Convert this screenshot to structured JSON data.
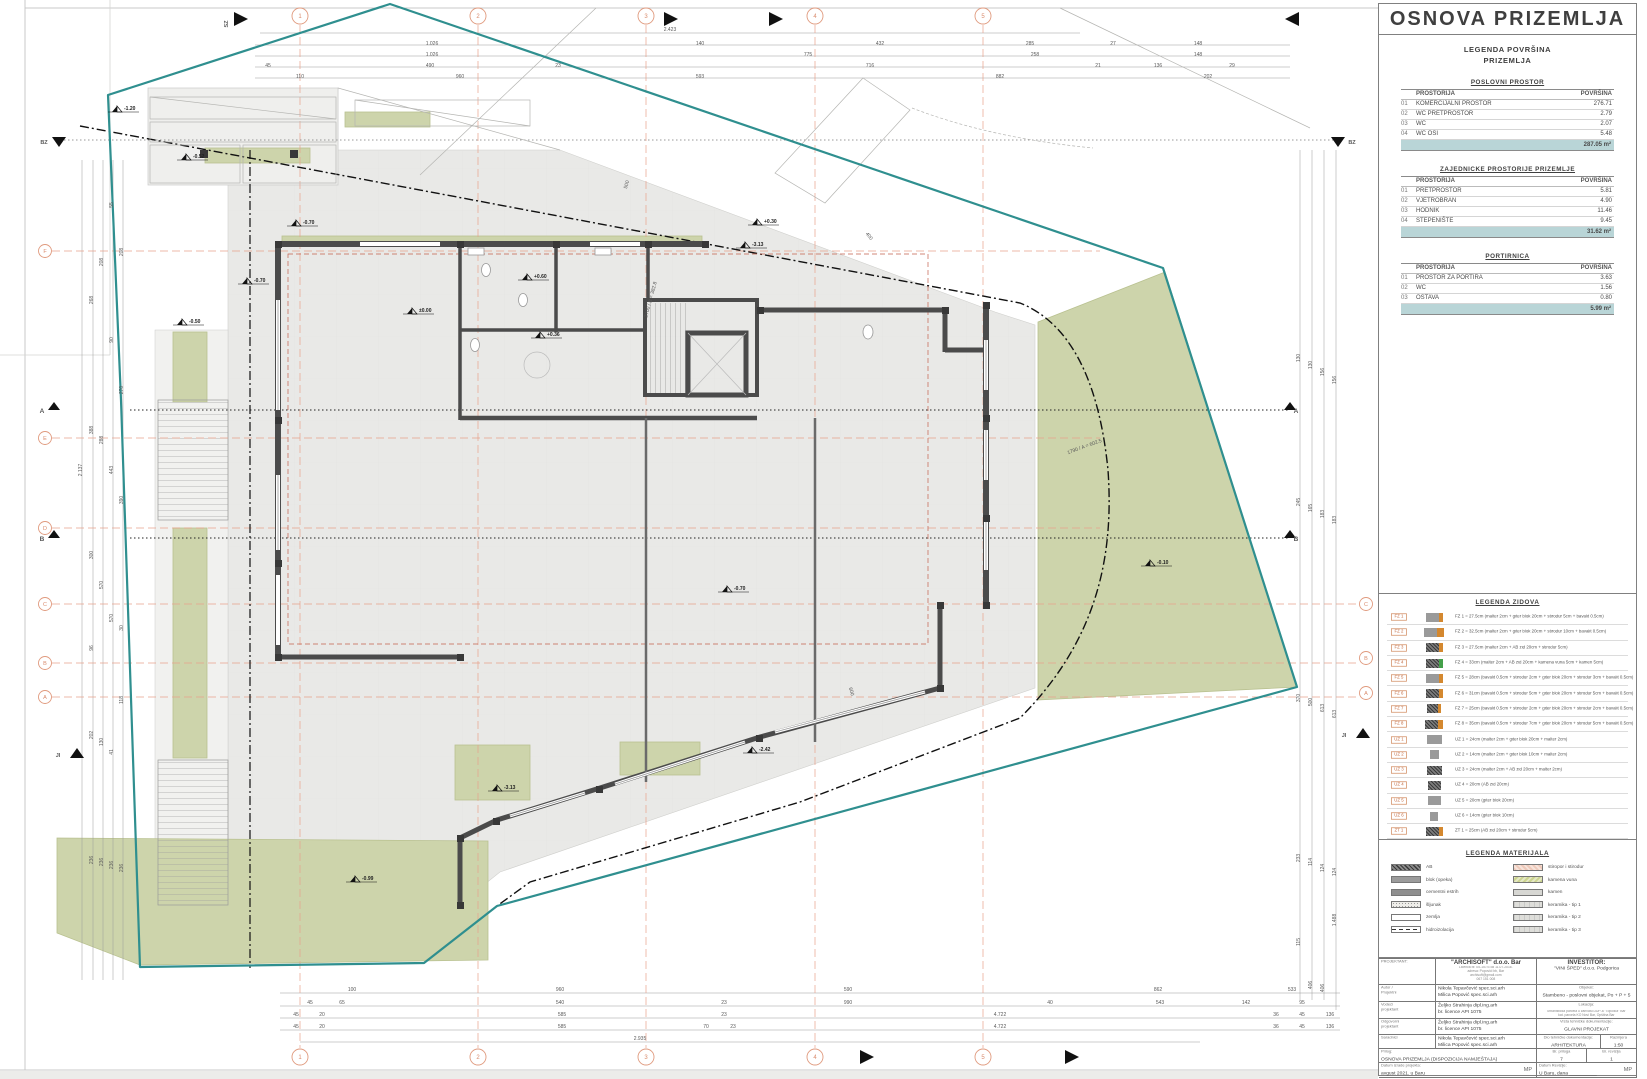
{
  "sheet": {
    "title": "OSNOVA PRIZEMLJA"
  },
  "colors": {
    "boundary": "#2f8f8f",
    "green": "#cdd4ab",
    "axis": "#e8a18c",
    "wall": "#4b4b4b",
    "total_row": "#b9d5d7",
    "tag": "#c2673c"
  },
  "legend": {
    "heading_line1": "LEGENDA POVRŠINA",
    "heading_line2": "PRIZEMLJA",
    "tables": [
      {
        "name": "POSLOVNI PROSTOR",
        "col_room": "PROSTORIJA",
        "col_area": "POVRŠINA",
        "rows": [
          [
            "01",
            "KOMERCIJALNI PROSTOR",
            "276.71"
          ],
          [
            "02",
            "WC PRETPROSTOR",
            "2.79"
          ],
          [
            "03",
            "WC",
            "2.07"
          ],
          [
            "04",
            "WC OSI",
            "5.48"
          ]
        ],
        "total": "287.05 m²"
      },
      {
        "name": "ZAJEDNICKE PROSTORIJE PRIZEMLJE",
        "col_room": "PROSTORIJA",
        "col_area": "POVRŠINA",
        "rows": [
          [
            "01",
            "PRETPROSTOR",
            "5.81"
          ],
          [
            "02",
            "VJETROBRAN",
            "4.90"
          ],
          [
            "03",
            "HODNIK",
            "11.46"
          ],
          [
            "04",
            "STEPENIŠTE",
            "9.45"
          ]
        ],
        "total": "31.62 m²"
      },
      {
        "name": "PORTIRNICA",
        "col_room": "PROSTORIJA",
        "col_area": "POVRŠINA",
        "rows": [
          [
            "01",
            "PROSTOR ZA PORTIRA",
            "3.63"
          ],
          [
            "02",
            "WC",
            "1.56"
          ],
          [
            "03",
            "OSTAVA",
            "0.80"
          ]
        ],
        "total": "5.99 m²"
      }
    ]
  },
  "walls_legend": {
    "title": "LEGENDA ZIDOVA",
    "rows": [
      {
        "tag": "FZ 1",
        "desc": "FZ 1 = 27.5cm (malter 2cm + giter blok 20cm + stirodur 5cm + bavalit 0.5cm)",
        "base": "g",
        "bw": 13,
        "ext": "o",
        "ew": 4
      },
      {
        "tag": "FZ 2",
        "desc": "FZ 2 = 32.5cm (malter 2cm + giter blok 20cm + stirodur 10cm + bavalit 0.5cm)",
        "base": "g",
        "bw": 13,
        "ext": "o",
        "ew": 7
      },
      {
        "tag": "FZ 3",
        "desc": "FZ 3 = 27.5cm (malter 2cm + AB zid 20cm + stirodur 5cm)",
        "base": "h",
        "bw": 13,
        "ext": "o",
        "ew": 4
      },
      {
        "tag": "FZ 4",
        "desc": "FZ 4 = 33cm (malter 2cm + AB zid 20cm + kamena vuna 5cm + kamen 5cm)",
        "base": "h",
        "bw": 13,
        "ext": "gr",
        "ew": 4
      },
      {
        "tag": "FZ 5",
        "desc": "FZ 5 = 28cm (bavalit 0.5cm + stirodur 2cm + giter blok 20cm + stirodur 3cm + bavalit 0.5cm)",
        "base": "g",
        "bw": 13,
        "ext": "o",
        "ew": 4
      },
      {
        "tag": "FZ 6",
        "desc": "FZ 6 = 31cm (bavalit 0.5cm + stirodur 5cm + giter blok 20cm + stirodur 5cm + bavalit 0.5cm)",
        "base": "h",
        "bw": 13,
        "ext": "o",
        "ew": 4
      },
      {
        "tag": "FZ 7",
        "desc": "FZ 7 = 25cm (bavalit 0.5cm + stirodur 2cm + giter blok 20cm + stirodur 2cm + bavalit 0.5cm)",
        "base": "h",
        "bw": 11,
        "ext": "o",
        "ew": 3
      },
      {
        "tag": "FZ 8",
        "desc": "FZ 8 = 35cm (bavalit 0.5cm + stirodur 7cm + giter blok 20cm + stirodur 5cm + bavalit 0.5cm)",
        "base": "h",
        "bw": 13,
        "ext": "o",
        "ew": 5
      },
      {
        "tag": "UZ 1",
        "desc": "UZ 1 = 24cm (malter 2cm + giter blok 20cm + malter 2cm)",
        "base": "g",
        "bw": 15,
        "ext": "",
        "ew": 0
      },
      {
        "tag": "UZ 2",
        "desc": "UZ 2 = 14cm (malter 2cm + giter blok 10cm + malter 2cm)",
        "base": "g",
        "bw": 9,
        "ext": "",
        "ew": 0
      },
      {
        "tag": "UZ 3",
        "desc": "UZ 3 = 24cm (malter 2cm + AB zid 20cm + malter 2cm)",
        "base": "h",
        "bw": 15,
        "ext": "",
        "ew": 0
      },
      {
        "tag": "UZ 4",
        "desc": "UZ 4 = 20cm (AB zid 20cm)",
        "base": "h",
        "bw": 13,
        "ext": "",
        "ew": 0
      },
      {
        "tag": "UZ 5",
        "desc": "UZ 5 = 20cm (giter blok 20cm)",
        "base": "g",
        "bw": 13,
        "ext": "",
        "ew": 0
      },
      {
        "tag": "UZ 6",
        "desc": "UZ 6 = 14cm (giter blok 10cm)",
        "base": "g",
        "bw": 8,
        "ext": "",
        "ew": 0
      },
      {
        "tag": "ZT 1",
        "desc": "ZT 1 = 25cm (AB zid 20cm + stirodur 5cm)",
        "base": "h",
        "bw": 13,
        "ext": "o",
        "ew": 4
      }
    ]
  },
  "materials_legend": {
    "title": "LEGENDA MATERIJALA",
    "left": [
      {
        "n": "AB",
        "cls": "sw-ab"
      },
      {
        "n": "blok (opeka)",
        "cls": "sw-blok"
      },
      {
        "n": "cementni estrih",
        "cls": "sw-estrih"
      },
      {
        "n": "šljunak",
        "cls": "sw-sljunak"
      },
      {
        "n": "zemlja",
        "cls": "sw-zemlja"
      },
      {
        "n": "hidroizolacija",
        "cls": "sw-hidro"
      }
    ],
    "right": [
      {
        "n": "stiropor i stirodur",
        "cls": "sw-stiropor"
      },
      {
        "n": "kamena vuna",
        "cls": "sw-vuna"
      },
      {
        "n": "kamen",
        "cls": "sw-kamen"
      },
      {
        "n": "keramika - tip 1",
        "cls": "sw-ker"
      },
      {
        "n": "keramika - tip 2",
        "cls": "sw-ker"
      },
      {
        "n": "keramika - tip 3",
        "cls": "sw-ker"
      }
    ]
  },
  "title_block": {
    "projektant_label": "PROJEKTANT:",
    "projektant_name": "\"ARCHISOFT\" d.o.o. Bar",
    "projektant_details": "Licenca br. 05-157/3 od 11.07.2016.\nadresa: Popovići bb, Bar\narchisoft@gmail.com\n067 151 008",
    "rows": [
      {
        "label": "Autor /\nProjektni",
        "value": "Nikola Tepavčević spec.sci.arh\nMilica Popović spec.sci.arh"
      },
      {
        "label": "Vodeći\nprojektant",
        "value": "Željko Strahinja dipl.ing.arh\nbr. licence API 1075"
      },
      {
        "label": "Odgovorni\nprojektant",
        "value": "Željko Strahinja dipl.ing.arh\nbr. licence API 1075"
      },
      {
        "label": "Saradnici",
        "value": "Nikola Tepavčević spec.sci.arh\nMilica Popović spec.sci.arh"
      }
    ],
    "prilog_label": "Prilog:",
    "prilog": "OSNOVA PRIZEMLJA (DISPOZICIJA NAMJEŠTAJA)",
    "datum_label": "Datum izrade projekta:",
    "datum": "avgust 2021. u Baru",
    "mp": "MP",
    "investitor_label": "INVESTITOR:",
    "investitor": "\"VINI ŠPED\" d.o.o. Podgorica",
    "objekat_label": "Objekat:",
    "objekat": "Stambeno - poslovni objekat, Po + P + 5",
    "lokacija_label": "Lokacija:",
    "lokacija": "urbanistička parcela u zahvatu DUP-a \"Topolica\" Bar\nkat. parcela KO Novi Bar, Opština Bar",
    "vrsta_label": "Vrsta tehničke dokumentacije:",
    "vrsta": "GLAVNI PROJEKAT",
    "dio_label": "Dio tehničke dokumentacije:",
    "dio": "ARHITEKTURA",
    "razmjera_label": "Razmjera",
    "razmjera": "1:50",
    "br_priloga_label": "Br. priloga",
    "br_priloga": "7",
    "br_revizije_label": "Br. revizija",
    "br_revizije": "1",
    "datum_rev_label": "Datum Revizije:",
    "datum_rev": "U Baru, dana __________",
    "mp2": "MP"
  },
  "plan": {
    "texts": [
      [
        670,
        31,
        "2.423"
      ],
      [
        432,
        45,
        "1.026"
      ],
      [
        700,
        45,
        "140"
      ],
      [
        880,
        45,
        "432"
      ],
      [
        1030,
        45,
        "285"
      ],
      [
        1113,
        45,
        "27"
      ],
      [
        1198,
        45,
        "148"
      ],
      [
        432,
        56,
        "1.026"
      ],
      [
        808,
        56,
        "775"
      ],
      [
        1035,
        56,
        "258"
      ],
      [
        1198,
        56,
        "148"
      ],
      [
        268,
        67,
        "45"
      ],
      [
        430,
        67,
        "490"
      ],
      [
        558,
        67,
        "23"
      ],
      [
        870,
        67,
        "716"
      ],
      [
        1098,
        67,
        "21"
      ],
      [
        1158,
        67,
        "136"
      ],
      [
        1232,
        67,
        "29"
      ],
      [
        300,
        78,
        "110"
      ],
      [
        460,
        78,
        "960"
      ],
      [
        700,
        78,
        "593"
      ],
      [
        1000,
        78,
        "882"
      ],
      [
        1208,
        78,
        "202"
      ],
      [
        352,
        991,
        "100"
      ],
      [
        560,
        991,
        "960"
      ],
      [
        848,
        991,
        "590"
      ],
      [
        1158,
        991,
        "862"
      ],
      [
        1292,
        991,
        "533"
      ],
      [
        310,
        1004,
        "45"
      ],
      [
        342,
        1004,
        "65"
      ],
      [
        560,
        1004,
        "540"
      ],
      [
        724,
        1004,
        "23"
      ],
      [
        848,
        1004,
        "990"
      ],
      [
        1050,
        1004,
        "40"
      ],
      [
        1160,
        1004,
        "543"
      ],
      [
        1246,
        1004,
        "142"
      ],
      [
        1302,
        1004,
        "95"
      ],
      [
        296,
        1016,
        "45"
      ],
      [
        322,
        1016,
        "20"
      ],
      [
        562,
        1016,
        "585"
      ],
      [
        724,
        1016,
        "23"
      ],
      [
        1000,
        1016,
        "4.722"
      ],
      [
        1276,
        1016,
        "36"
      ],
      [
        1302,
        1016,
        "45"
      ],
      [
        1330,
        1016,
        "136"
      ],
      [
        296,
        1028,
        "45"
      ],
      [
        322,
        1028,
        "20"
      ],
      [
        562,
        1028,
        "585"
      ],
      [
        706,
        1028,
        "70"
      ],
      [
        733,
        1028,
        "23"
      ],
      [
        1000,
        1028,
        "4.722"
      ],
      [
        1276,
        1028,
        "36"
      ],
      [
        1302,
        1028,
        "45"
      ],
      [
        1330,
        1028,
        "136"
      ],
      [
        640,
        1040,
        "2.935"
      ],
      [
        82,
        470,
        "2.137",
        -90
      ],
      [
        93,
        300,
        "268",
        -90
      ],
      [
        93,
        430,
        "388",
        -90
      ],
      [
        93,
        555,
        "300",
        -90
      ],
      [
        93,
        648,
        "96",
        -90
      ],
      [
        93,
        735,
        "202",
        -90
      ],
      [
        93,
        860,
        "236",
        -90
      ],
      [
        103,
        262,
        "208",
        -90
      ],
      [
        103,
        440,
        "288",
        -90
      ],
      [
        103,
        585,
        "570",
        -90
      ],
      [
        103,
        742,
        "130",
        -90
      ],
      [
        103,
        862,
        "236",
        -90
      ],
      [
        113,
        205,
        "55",
        -90
      ],
      [
        113,
        340,
        "90",
        -90
      ],
      [
        113,
        470,
        "443",
        -90
      ],
      [
        113,
        618,
        "570",
        -90
      ],
      [
        113,
        752,
        "41",
        -90
      ],
      [
        113,
        865,
        "236",
        -90
      ],
      [
        123,
        252,
        "208",
        -90
      ],
      [
        123,
        390,
        "270",
        -90
      ],
      [
        123,
        500,
        "390",
        -90
      ],
      [
        123,
        628,
        "30",
        -90
      ],
      [
        123,
        700,
        "118",
        -90
      ],
      [
        123,
        868,
        "236",
        -90
      ],
      [
        1300,
        358,
        "130",
        -90
      ],
      [
        1300,
        502,
        "245",
        -90
      ],
      [
        1300,
        698,
        "370",
        -90
      ],
      [
        1300,
        858,
        "233",
        -90
      ],
      [
        1300,
        942,
        "115",
        -90
      ],
      [
        1312,
        365,
        "130",
        -90
      ],
      [
        1312,
        508,
        "165",
        -90
      ],
      [
        1312,
        702,
        "500",
        -90
      ],
      [
        1312,
        862,
        "114",
        -90
      ],
      [
        1312,
        985,
        "406",
        -90
      ],
      [
        1324,
        372,
        "156",
        -90
      ],
      [
        1324,
        514,
        "183",
        -90
      ],
      [
        1324,
        708,
        "613",
        -90
      ],
      [
        1324,
        868,
        "124",
        -90
      ],
      [
        1324,
        988,
        "406",
        -90
      ],
      [
        1336,
        380,
        "156",
        -90
      ],
      [
        1336,
        520,
        "183",
        -90
      ],
      [
        1336,
        714,
        "613",
        -90
      ],
      [
        1336,
        872,
        "124",
        -90
      ],
      [
        1336,
        920,
        "1.488",
        -90
      ],
      [
        652,
        300,
        "2700 / B = 382.8",
        -75
      ],
      [
        1085,
        448,
        "1790 / A = 602.5",
        -20
      ],
      [
        628,
        185,
        "500",
        -72
      ],
      [
        868,
        237,
        "400",
        52
      ],
      [
        850,
        692,
        "600",
        72
      ],
      [
        228,
        24,
        "SZ",
        -90,
        5.5,
        1
      ],
      [
        44,
        144,
        "BZ",
        0,
        5.5,
        1
      ],
      [
        1352,
        144,
        "BZ",
        0,
        5.5,
        1
      ],
      [
        58,
        757,
        "JI",
        0,
        5.5,
        1
      ],
      [
        1344,
        737,
        "JI",
        0,
        5.5,
        1
      ],
      [
        42,
        413,
        "A",
        0,
        6.5,
        1
      ],
      [
        42,
        541,
        "B",
        0,
        6.5,
        1
      ],
      [
        1296,
        413,
        "A",
        0,
        6.5,
        1
      ],
      [
        1296,
        541,
        "B",
        0,
        6.5,
        1
      ]
    ],
    "bubbles": [
      [
        300,
        16,
        "1"
      ],
      [
        478,
        16,
        "2"
      ],
      [
        646,
        16,
        "3"
      ],
      [
        815,
        16,
        "4"
      ],
      [
        983,
        16,
        "5"
      ],
      [
        300,
        1057,
        "1"
      ],
      [
        478,
        1057,
        "2"
      ],
      [
        646,
        1057,
        "3"
      ],
      [
        815,
        1057,
        "4"
      ],
      [
        983,
        1057,
        "5"
      ],
      [
        45,
        251,
        "F",
        1
      ],
      [
        45,
        438,
        "E",
        1
      ],
      [
        45,
        528,
        "D",
        1
      ],
      [
        45,
        604,
        "C",
        1
      ],
      [
        45,
        663,
        "B",
        1
      ],
      [
        45,
        697,
        "A",
        1
      ],
      [
        1366,
        604,
        "C",
        1
      ],
      [
        1366,
        658,
        "B",
        1
      ],
      [
        1366,
        693,
        "A",
        1
      ]
    ],
    "levels": [
      [
        117,
        112,
        "-1.20"
      ],
      [
        186,
        160,
        "-0.52"
      ],
      [
        182,
        325,
        "-0.50"
      ],
      [
        355,
        882,
        "-0.99"
      ],
      [
        412,
        314,
        "±0.00"
      ],
      [
        527,
        280,
        "+0.60"
      ],
      [
        757,
        225,
        "+0.30"
      ],
      [
        296,
        226,
        "-0.70"
      ],
      [
        247,
        284,
        "-0.70"
      ],
      [
        745,
        248,
        "-3.13"
      ],
      [
        1150,
        566,
        "-0.10"
      ],
      [
        727,
        592,
        "-0.70"
      ],
      [
        752,
        753,
        "-2.42"
      ],
      [
        497,
        791,
        "-3.13"
      ],
      [
        540,
        338,
        "+0.36"
      ]
    ]
  }
}
